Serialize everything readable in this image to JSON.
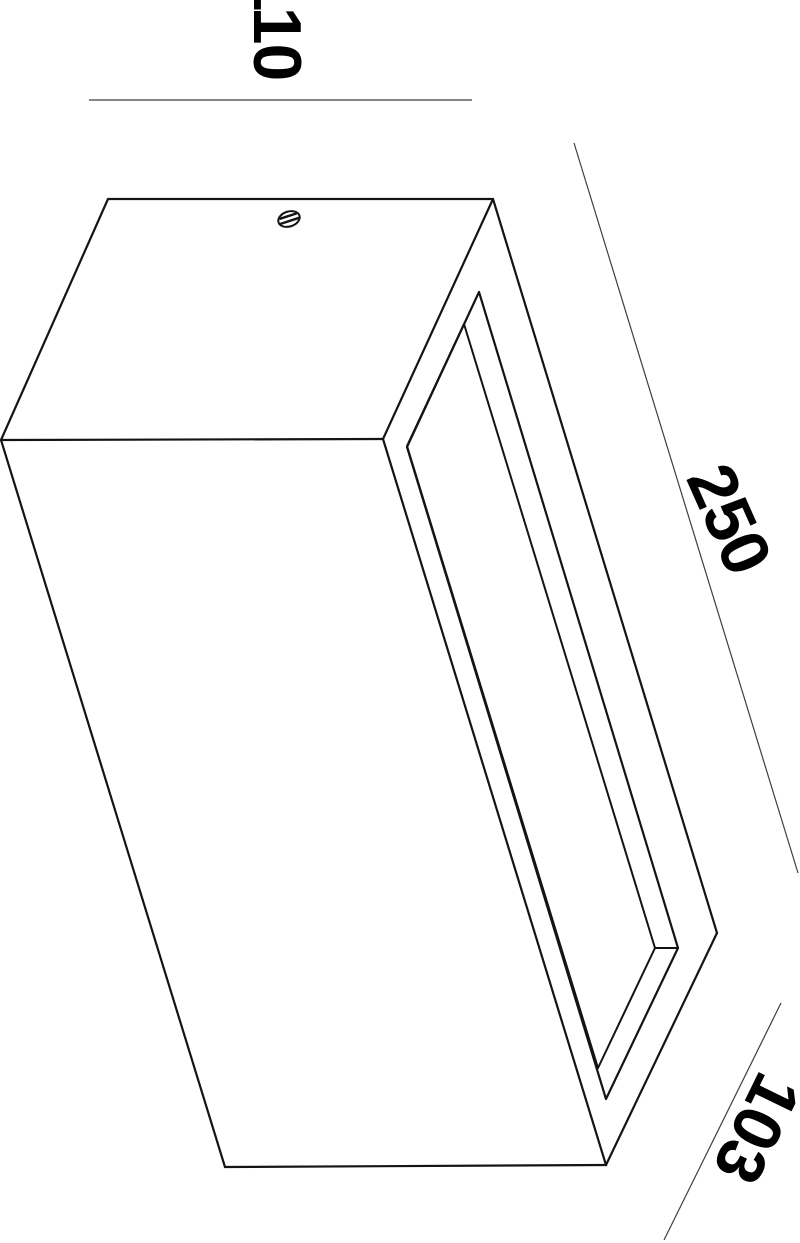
{
  "drawing": {
    "kind": "isometric dimensional drawing",
    "object": "rectangular box fixture with recessed rectangular opening and slotted screw on top",
    "background_color": "#ffffff",
    "edge_color": "#141414",
    "dim_line_color": "#3f3f3f",
    "text_color": "#000000",
    "dimensions": {
      "width": "110",
      "length": "250",
      "depth": "103"
    }
  }
}
